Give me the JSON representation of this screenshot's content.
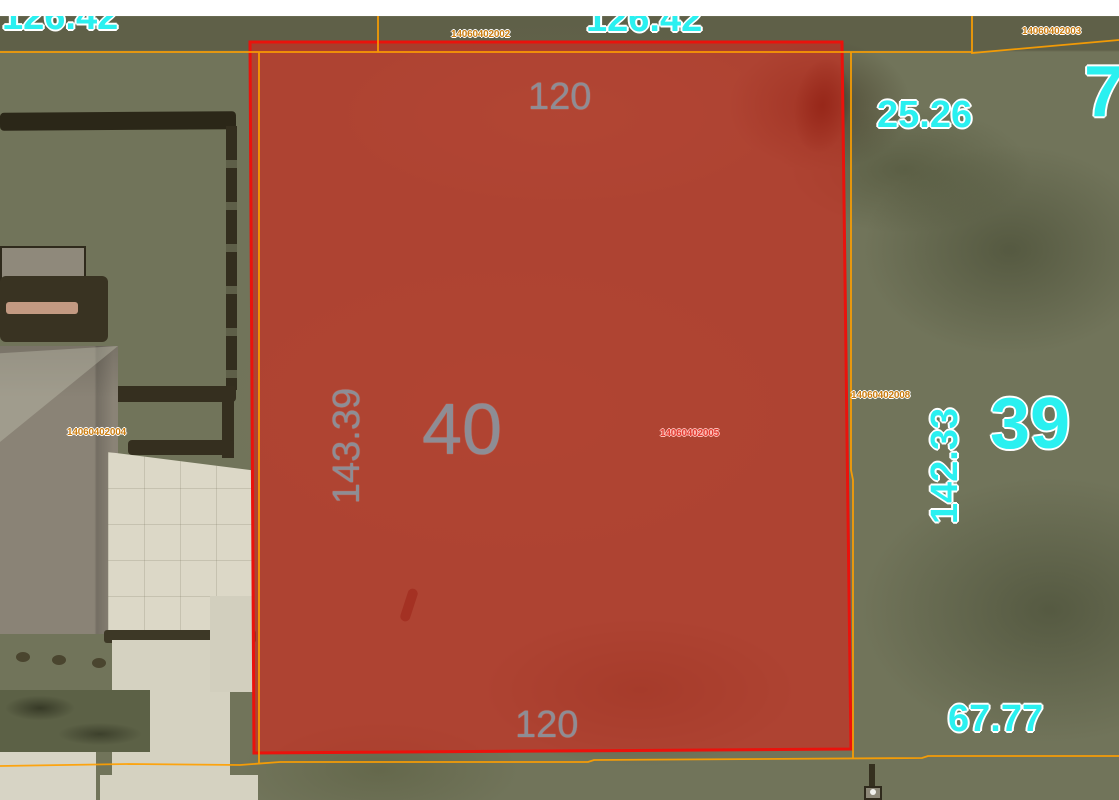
{
  "app": {
    "type": "gis-parcel-map-viewer",
    "view": "aerial-imagery-with-parcel-overlay"
  },
  "selected_parcel": {
    "number": "40",
    "parcel_id": "14060402005",
    "frontage_top": "120",
    "frontage_bottom": "120",
    "depth_left": "143.39",
    "highlight_fill": "#cf2a1e",
    "highlight_outline": "#ea120c"
  },
  "labels": {
    "dim_126_42_left": "126.42",
    "dim_126_42_top": "126.42",
    "dim_25_26": "25.26",
    "num_74": "74",
    "dim_142_33": "142.33",
    "num_39": "39",
    "dim_67_77": "67.77",
    "dim_120_top": "120",
    "dim_120_bottom": "120",
    "dim_143_39": "143.39",
    "num_40": "40",
    "pid_north": "14060402002",
    "pid_northeast": "14060402003",
    "pid_west": "14060402004",
    "pid_selected": "14060402005",
    "pid_east": "14060402008"
  },
  "colors": {
    "dimension_text": "#2af0f0",
    "parcel_number_text": "#8d8d95",
    "parcel_id_text": "#c97c10",
    "selected_parcel_id_text": "#e03a2f",
    "boundary_line": "#ffa000",
    "top_band": "#ffffff"
  }
}
